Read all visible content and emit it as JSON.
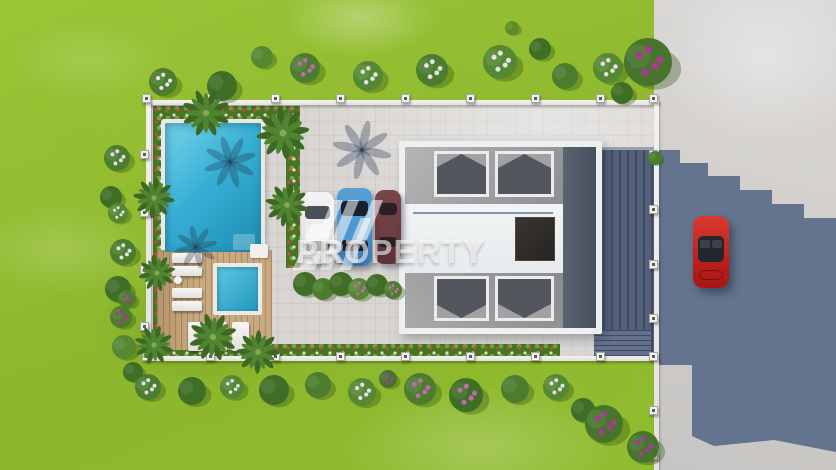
{
  "watermark": {
    "line1": "ART",
    "line2": "PROPERTY"
  },
  "palette": {
    "lawn_green": "#8fbd2c",
    "road_gray": "#d3d1cf",
    "building_shadow_blue": "#5e6d8a",
    "pavement_gray": "#d8d5d2",
    "pool_cyan": "#2fa9cd",
    "deck_wood": "#c9a97f",
    "roof_gray": "#a3a2a5",
    "roof_shadow_slope": "#4d5767",
    "house_white": "#eef0f2",
    "fence_white": "#edecea",
    "flower_magenta": "#a83a94",
    "flower_white": "#e8e0ea",
    "car_white": "#e9eaea",
    "car_blue": "#4289c8",
    "car_maroon": "#6b3940",
    "car_red": "#c3221f"
  },
  "scene_counts": {
    "parked_cars": 3,
    "street_cars": 1,
    "pools": 2,
    "sun_loungers": 7,
    "palm_trees": 8
  }
}
